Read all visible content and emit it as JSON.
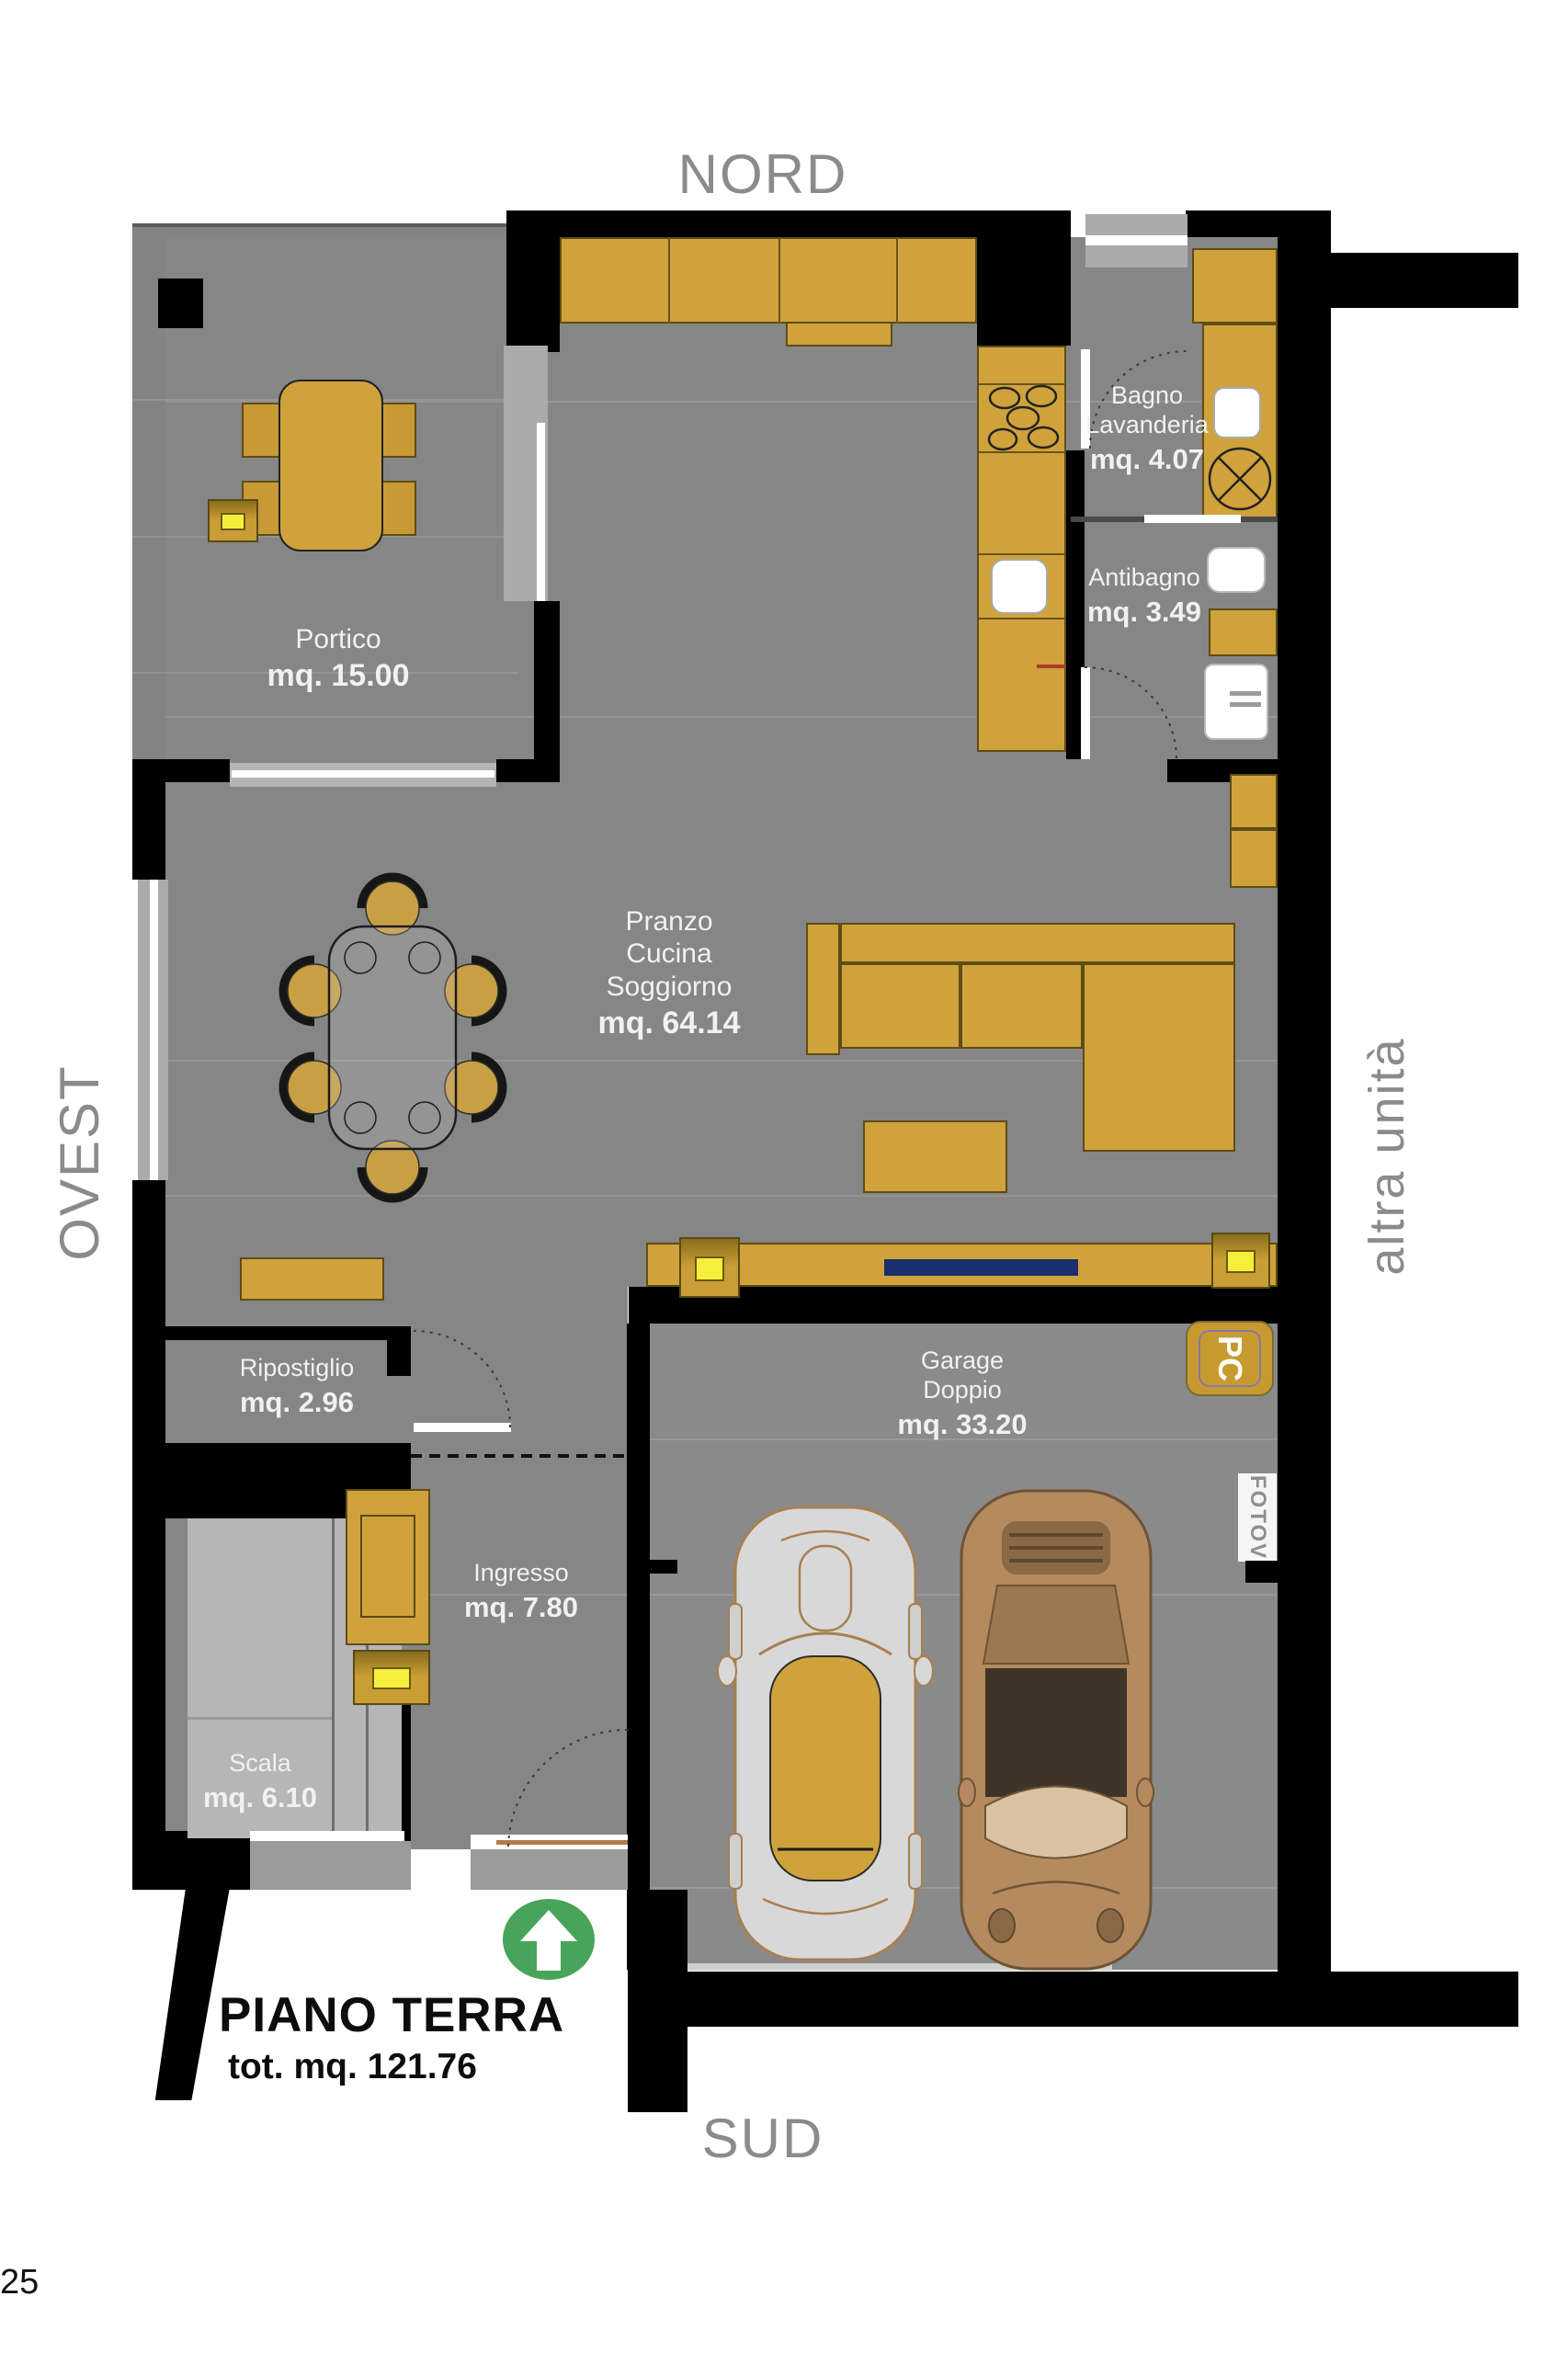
{
  "compass": {
    "north": "NORD",
    "south": "SUD",
    "west": "OVEST",
    "adjacent_unit": "altra unità"
  },
  "title": {
    "main": "PIANO TERRA",
    "total": "tot. mq. 121.76"
  },
  "page_number": "25",
  "rooms": [
    {
      "id": "portico",
      "name": "Portico",
      "area": "mq. 15.00"
    },
    {
      "id": "bagno",
      "name": "Bagno\nLavanderia",
      "area": "mq. 4.07"
    },
    {
      "id": "antibagno",
      "name": "Antibagno",
      "area": "mq. 3.49"
    },
    {
      "id": "soggiorno",
      "name": "Pranzo\nCucina\nSoggiorno",
      "area": "mq. 64.14"
    },
    {
      "id": "ripostiglio",
      "name": "Ripostiglio",
      "area": "mq. 2.96"
    },
    {
      "id": "garage",
      "name": "Garage\nDoppio",
      "area": "mq. 33.20"
    },
    {
      "id": "ingresso",
      "name": "Ingresso",
      "area": "mq. 7.80"
    },
    {
      "id": "scala",
      "name": "Scala",
      "area": "mq. 6.10"
    }
  ],
  "badges": {
    "pc": "PC",
    "fotov": "FOTOV"
  },
  "colors": {
    "furniture_gold": "#CFA23C",
    "floor_gray": "#868686",
    "wall_black": "#000000",
    "stair_gray": "#B6B6B6",
    "window_gray": "#ABABAB",
    "tv_navy": "#1B2E6E",
    "speaker_yellow": "#F4EF3C",
    "entry_green": "#47A45A",
    "silver_car": "#D8D8D8",
    "bronze_car": "#B48A5E",
    "label_text": "#F1F1F1",
    "compass_gray": "#8B8B8B"
  }
}
